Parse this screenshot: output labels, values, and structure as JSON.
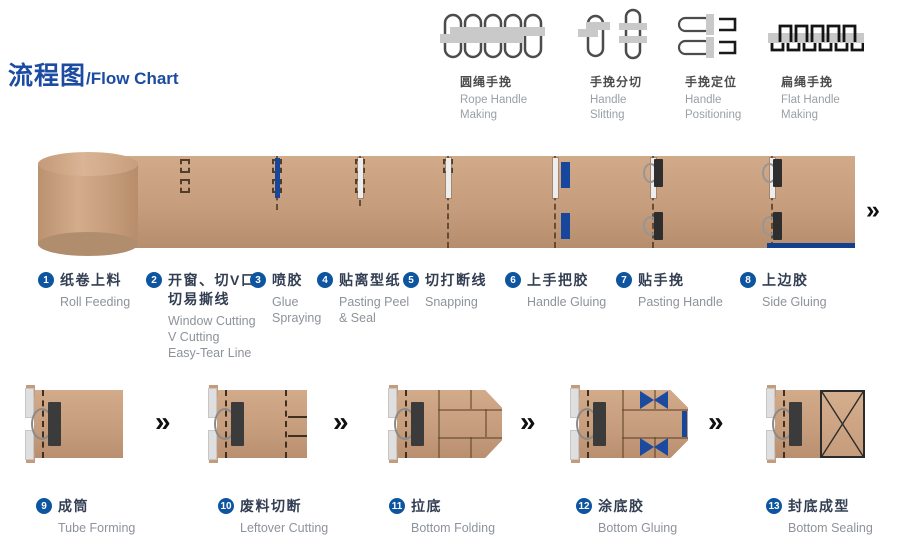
{
  "title": {
    "zh": "流程图",
    "en": "/Flow Chart"
  },
  "legend": [
    {
      "icon": "rope-handle-making-icon",
      "zh": "圆绳手挽",
      "en": "Rope Handle\nMaking"
    },
    {
      "icon": "handle-slitting-icon",
      "zh": "手挽分切",
      "en": "Handle\nSlitting"
    },
    {
      "icon": "handle-positioning-icon",
      "zh": "手挽定位",
      "en": "Handle\nPositioning"
    },
    {
      "icon": "flat-handle-making-icon",
      "zh": "扁绳手挽",
      "en": "Flat Handle\nMaking"
    }
  ],
  "web_steps": [
    {
      "num": "1",
      "zh": "纸卷上料",
      "en": "Roll Feeding"
    },
    {
      "num": "2",
      "zh": "开窗、切V口\n切易撕线",
      "en": "Window Cutting\nV Cutting\nEasy-Tear Line"
    },
    {
      "num": "3",
      "zh": "喷胶",
      "en": "Glue\nSpraying"
    },
    {
      "num": "4",
      "zh": "贴离型纸",
      "en": "Pasting Peel\n& Seal"
    },
    {
      "num": "5",
      "zh": "切打断线",
      "en": "Snapping"
    },
    {
      "num": "6",
      "zh": "上手把胶",
      "en": "Handle Gluing"
    },
    {
      "num": "7",
      "zh": "贴手挽",
      "en": "Pasting Handle"
    },
    {
      "num": "8",
      "zh": "上边胶",
      "en": "Side Gluing"
    }
  ],
  "bag_steps": [
    {
      "num": "9",
      "zh": "成筒",
      "en": "Tube Forming"
    },
    {
      "num": "10",
      "zh": "废料切断",
      "en": "Leftover Cutting"
    },
    {
      "num": "11",
      "zh": "拉底",
      "en": "Bottom Folding"
    },
    {
      "num": "12",
      "zh": "涂底胶",
      "en": "Bottom Gluing"
    },
    {
      "num": "13",
      "zh": "封底成型",
      "en": "Bottom Sealing"
    }
  ],
  "arrow_char": "»",
  "colors": {
    "title_blue": "#1c4ba2",
    "circle_blue": "#0e55a0",
    "accent_blue": "#17479c",
    "paper_tan": "#c69d7d",
    "text_dark": "#333e52",
    "text_gray": "#8d939b"
  }
}
